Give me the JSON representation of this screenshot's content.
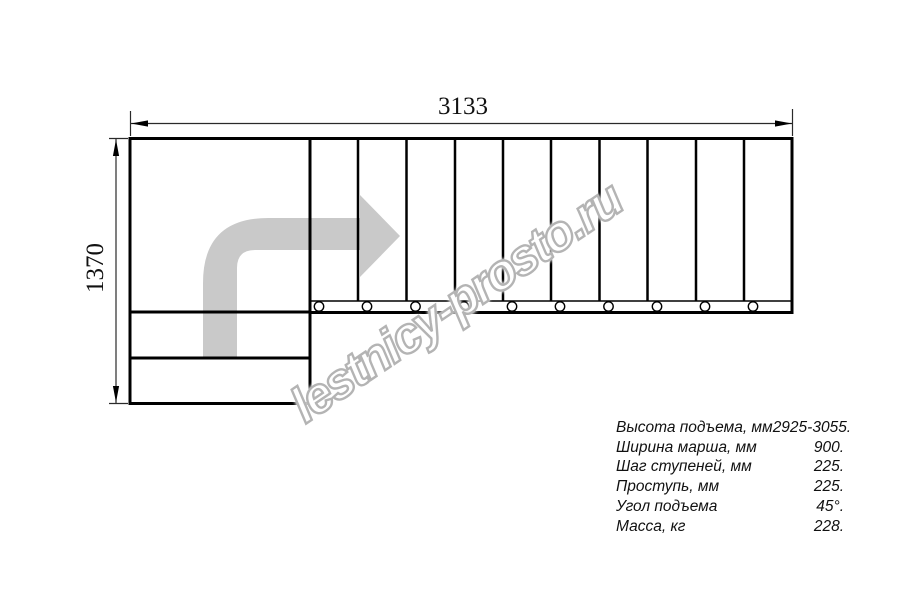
{
  "drawing": {
    "width_dim": "3133",
    "height_dim": "1370",
    "watermark": "lestnicy-prosto.ru"
  },
  "staircase": {
    "straight_flight_treads": 10,
    "entry_steps": 2,
    "balusters": 10
  },
  "colors": {
    "line": "#000000",
    "arrow_fill": "#c9c9c9",
    "watermark_stroke": "#b4b4b4",
    "background": "#ffffff"
  },
  "specs": {
    "rows": [
      {
        "label": "Высота подъема, мм",
        "value": "2925-3055."
      },
      {
        "label": "Ширина марша, мм",
        "value": "900."
      },
      {
        "label": "Шаг ступеней, мм",
        "value": "225."
      },
      {
        "label": "Проступь, мм",
        "value": "225."
      },
      {
        "label": "Угол подъема",
        "value": "45°."
      },
      {
        "label": "Масса, кг",
        "value": "228."
      }
    ]
  }
}
